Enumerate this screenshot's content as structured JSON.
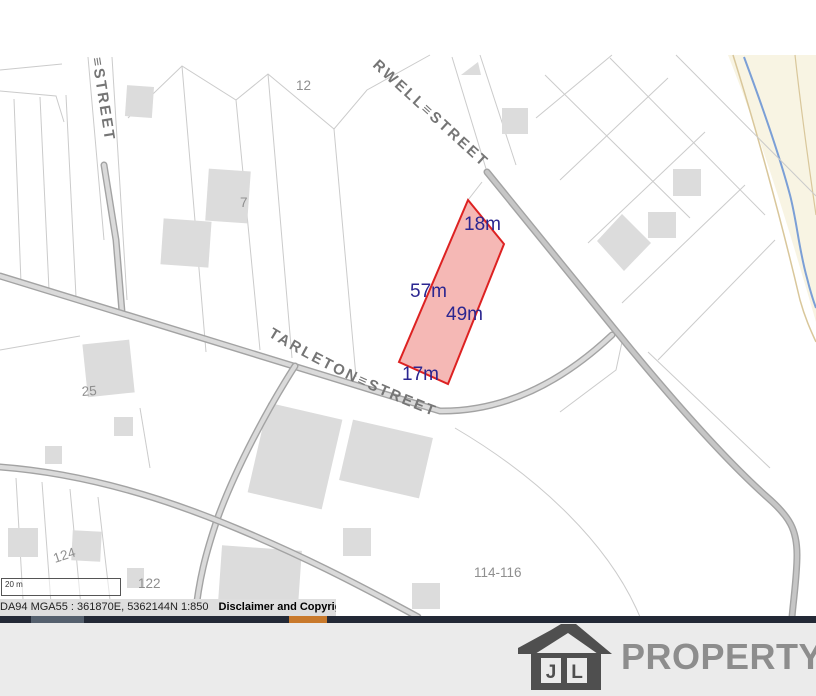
{
  "map": {
    "streets": {
      "left_vertical": "≡STREET",
      "top_diagonal": "RWELL≡STREET",
      "tarleton": "TARLETON≡STREET"
    },
    "subject_lot": {
      "measurements": {
        "top": "18m",
        "left": "57m",
        "right": "49m",
        "bottom": "17m"
      }
    },
    "lot_numbers": [
      "12",
      "7",
      "25",
      "124",
      "122",
      "114-116"
    ],
    "colors": {
      "lot_fill": "#f2a09c",
      "lot_stroke": "#dd2222",
      "dimension_text": "#2b2690",
      "road_gray": "#a3a3a3",
      "parcel_line": "#cbcbcb",
      "building_fill": "#dcdcdc",
      "stream_blue": "#7b9fd6",
      "contour_tan": "#d9c79b",
      "cream_area": "#f8f4e3",
      "bar_dark": "#232936",
      "bar_orange": "#c8792b",
      "logo_gray": "#4f4f4f",
      "brand_gray": "#8d8d8d"
    }
  },
  "scalebar": {
    "label": "20 m"
  },
  "statusbar": {
    "coordinates": "DA94 MGA55 : 361870E, 5362144N 1:850",
    "notice": "Disclaimer and Copyright Notice"
  },
  "footer": {
    "logo_letter_1": "J",
    "logo_letter_2": "L",
    "brand": "PROPERTY"
  }
}
